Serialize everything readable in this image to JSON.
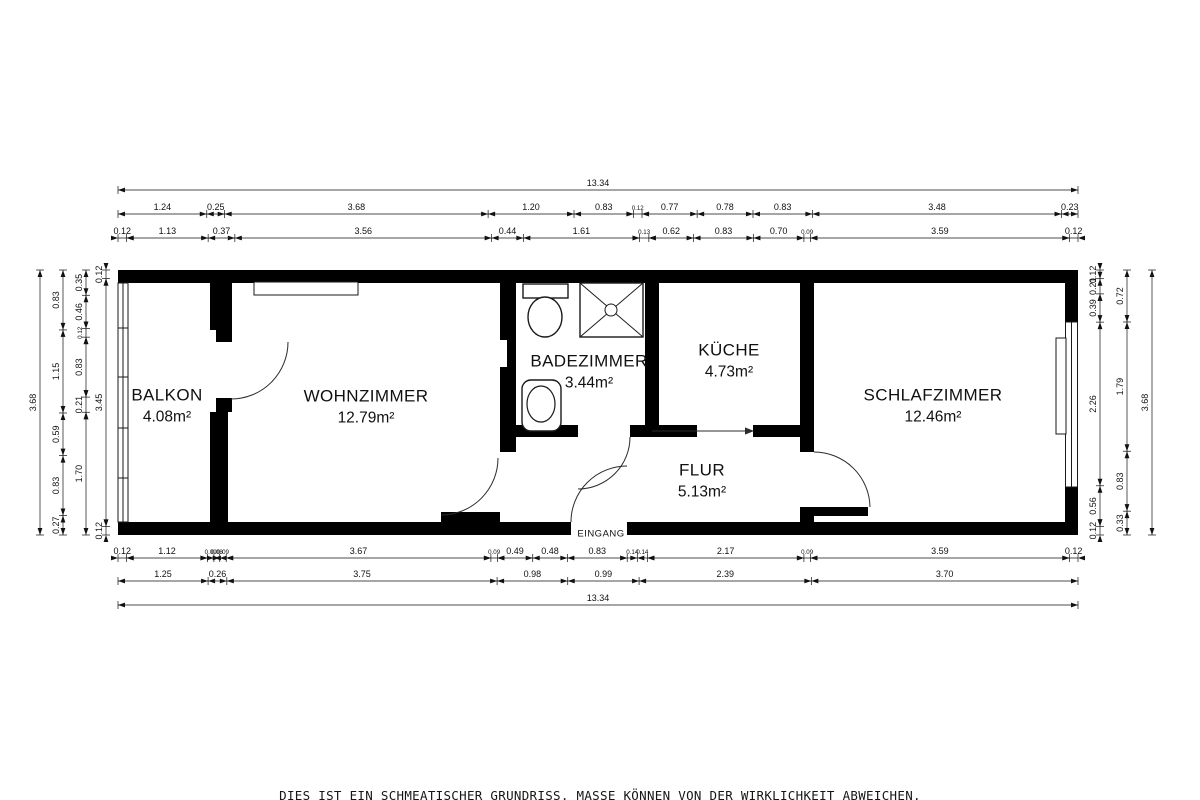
{
  "plan": {
    "entrance_label": "EINGANG",
    "wall_color": "#000000",
    "background_color": "#ffffff",
    "rooms": [
      {
        "id": "balkon",
        "name": "BALKON",
        "area": "4.08m²",
        "cx": 167,
        "cy": 406
      },
      {
        "id": "wohnzimmer",
        "name": "WOHNZIMMER",
        "area": "12.79m²",
        "cx": 366,
        "cy": 407
      },
      {
        "id": "badezimmer",
        "name": "BADEZIMMER",
        "area": "3.44m²",
        "cx": 589,
        "cy": 372
      },
      {
        "id": "kueche",
        "name": "KÜCHE",
        "area": "4.73m²",
        "cx": 729,
        "cy": 361
      },
      {
        "id": "flur",
        "name": "FLUR",
        "area": "5.13m²",
        "cx": 702,
        "cy": 481
      },
      {
        "id": "schlafzimmer",
        "name": "SCHLAFZIMMER",
        "area": "12.46m²",
        "cx": 933,
        "cy": 406
      }
    ],
    "total_width_m": "13.34",
    "total_height_m": "3.68"
  },
  "dimensions": {
    "chains": [
      {
        "side": "top",
        "pos": 190,
        "values": [
          "13.34"
        ]
      },
      {
        "side": "top",
        "pos": 214,
        "values": [
          "1.24",
          "0.25",
          "3.68",
          "1.20",
          "0.83",
          "0.12",
          "0.77",
          "0.78",
          "0.83",
          "3.48",
          "0.23"
        ]
      },
      {
        "side": "top",
        "pos": 238,
        "values": [
          "0.12",
          "1.13",
          "0.37",
          "3.56",
          "0.44",
          "1.61",
          "0.13",
          "0.62",
          "0.83",
          "0.70",
          "0.09",
          "3.59",
          "0.12"
        ]
      },
      {
        "side": "bottom",
        "pos": 558,
        "values": [
          "0.12",
          "1.12",
          "0.09",
          "0.08",
          "0.09",
          "3.67",
          "0.09",
          "0.49",
          "0.48",
          "0.83",
          "0.14",
          "0.14",
          "2.17",
          "0.09",
          "3.59",
          "0.12"
        ]
      },
      {
        "side": "bottom",
        "pos": 581,
        "values": [
          "1.25",
          "0.26",
          "3.75",
          "0.98",
          "0.99",
          "2.39",
          "3.70"
        ]
      },
      {
        "side": "bottom",
        "pos": 605,
        "values": [
          "13.34"
        ]
      },
      {
        "side": "left",
        "pos": 40,
        "values": [
          "3.68"
        ]
      },
      {
        "side": "left",
        "pos": 63,
        "values": [
          "0.83",
          "1.15",
          "0.59",
          "0.83",
          "0.27"
        ]
      },
      {
        "side": "left",
        "pos": 86,
        "values": [
          "0.35",
          "0.46",
          "0.12",
          "0.83",
          "0.21",
          "1.70"
        ]
      },
      {
        "side": "left",
        "pos": 106,
        "values": [
          "0.12",
          "3.45",
          "0.12"
        ]
      },
      {
        "side": "right",
        "pos": 1100,
        "values": [
          "0.12",
          "0.21",
          "0.39",
          "2.26",
          "0.56",
          "0.12"
        ]
      },
      {
        "side": "right",
        "pos": 1127,
        "values": [
          "0.72",
          "1.79",
          "0.83",
          "0.33"
        ]
      },
      {
        "side": "right",
        "pos": 1152,
        "values": [
          "3.68"
        ]
      }
    ]
  },
  "disclaimer": "DIES IST EIN SCHMEATISCHER GRUNDRISS. MASSE KÖNNEN VON DER WIRKLICHKEIT ABWEICHEN."
}
